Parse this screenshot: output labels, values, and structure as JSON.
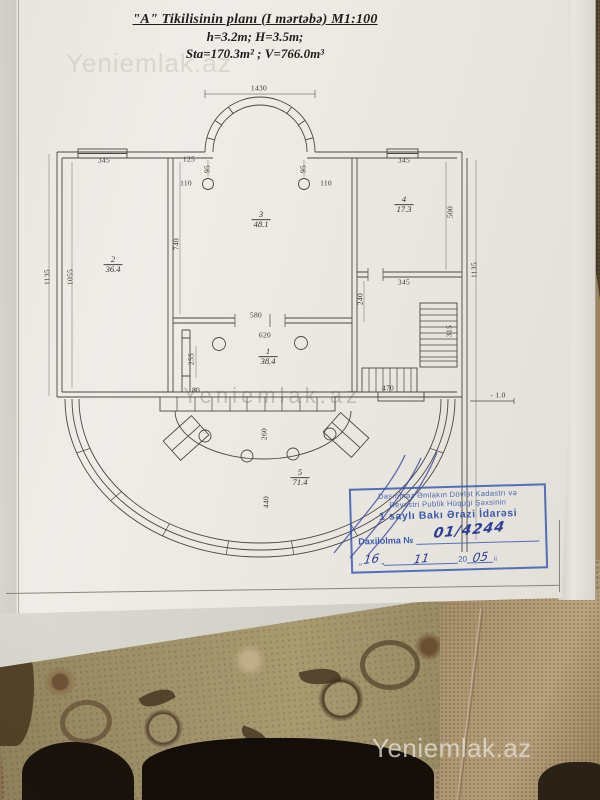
{
  "watermark": "Yeniemlak.az",
  "title": {
    "line1": "\"A\" Tikilisinin planı (I mərtəbə) M1:100",
    "line2": "h=3.2m; H=3.5m;",
    "line3": "Sta=170.3m² ; V=766.0m³"
  },
  "plan": {
    "rooms": [
      {
        "num": "1",
        "area": "38.4",
        "x": 268,
        "y": 357
      },
      {
        "num": "2",
        "area": "36.4",
        "x": 113,
        "y": 265
      },
      {
        "num": "3",
        "area": "48.1",
        "x": 261,
        "y": 220
      },
      {
        "num": "4",
        "area": "17.3",
        "x": 404,
        "y": 205
      },
      {
        "num": "5",
        "area": "71.4",
        "x": 300,
        "y": 478
      }
    ],
    "dims": [
      {
        "t": "1430",
        "x": 259,
        "y": 88
      },
      {
        "t": "345",
        "x": 104,
        "y": 160
      },
      {
        "t": "125",
        "x": 189,
        "y": 159
      },
      {
        "t": "95",
        "x": 207,
        "y": 169,
        "v": 1
      },
      {
        "t": "110",
        "x": 186,
        "y": 183
      },
      {
        "t": "95",
        "x": 303,
        "y": 169,
        "v": 1
      },
      {
        "t": "110",
        "x": 326,
        "y": 183
      },
      {
        "t": "345",
        "x": 404,
        "y": 160
      },
      {
        "t": "1135",
        "x": 47,
        "y": 277,
        "v": 1
      },
      {
        "t": "1055",
        "x": 70,
        "y": 277,
        "v": 1
      },
      {
        "t": "740",
        "x": 176,
        "y": 244,
        "v": 1
      },
      {
        "t": "500",
        "x": 450,
        "y": 212,
        "v": 1
      },
      {
        "t": "1135",
        "x": 474,
        "y": 270,
        "v": 1
      },
      {
        "t": "345",
        "x": 404,
        "y": 282
      },
      {
        "t": "240",
        "x": 360,
        "y": 299,
        "v": 1
      },
      {
        "t": "580",
        "x": 256,
        "y": 315
      },
      {
        "t": "620",
        "x": 265,
        "y": 335
      },
      {
        "t": "315",
        "x": 449,
        "y": 331,
        "v": 1
      },
      {
        "t": "255",
        "x": 191,
        "y": 359,
        "v": 1
      },
      {
        "t": "80",
        "x": 196,
        "y": 390
      },
      {
        "t": "470",
        "x": 388,
        "y": 388
      },
      {
        "t": "- 1.0",
        "x": 498,
        "y": 395
      },
      {
        "t": "260",
        "x": 264,
        "y": 434,
        "v": 1
      },
      {
        "t": "440",
        "x": 266,
        "y": 502,
        "v": 1
      }
    ]
  },
  "stamp": {
    "org_line1": "Daşınmaz Əmlakın Dövlət Kadastrı və",
    "org_line2": "Reyestri Publik Hüquqi Şəxsinin",
    "org_line3": "1 saylı Bakı Ərazi İdarəsi",
    "reg_label": "Daxilolma №",
    "reg_value": "01/4244",
    "date_open_quote": "„",
    "day": "16",
    "date_close_quote": "„",
    "month": "11",
    "year_prefix": "20",
    "year_value": "05",
    "year_suffix": "il"
  }
}
